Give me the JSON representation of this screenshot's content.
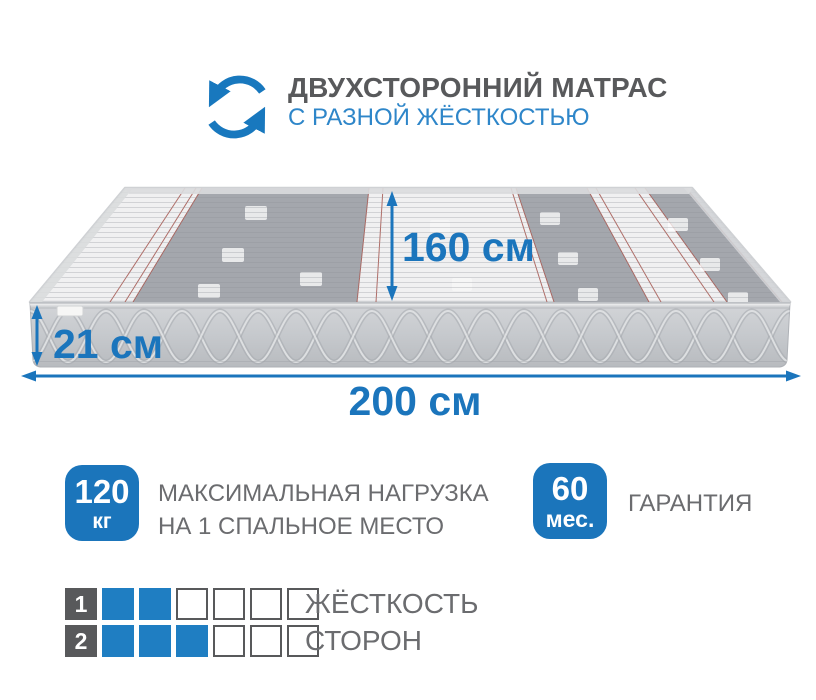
{
  "header": {
    "title": "ДВУХСТОРОННИЙ МАТРАС",
    "subtitle": "С РАЗНОЙ ЖЁСТКОСТЬЮ",
    "icon": "flip-rotate-arrows"
  },
  "mattress": {
    "width_label": "160 см",
    "height_label": "21 см",
    "length_label": "200 см"
  },
  "badges": [
    {
      "value": "120",
      "unit": "кг",
      "label_lines": [
        "МАКСИМАЛЬНАЯ НАГРУЗКА",
        "НА 1 СПАЛЬНОЕ МЕСТО"
      ]
    },
    {
      "value": "60",
      "unit": "мес.",
      "label_lines": [
        "ГАРАНТИЯ"
      ]
    }
  ],
  "firmness": {
    "label_lines": [
      "ЖЁСТКОСТЬ",
      "СТОРОН"
    ],
    "scale_max": 6,
    "rows": [
      {
        "side": "1",
        "level": 2
      },
      {
        "side": "2",
        "level": 3
      }
    ]
  },
  "colors": {
    "accent_blue": "#1b75bc",
    "subtitle_blue": "#2e86c9",
    "icon_blue": "#1878be",
    "square_blue": "#1f7ec2",
    "dark_gray": "#58595b",
    "label_gray": "#6b6c6f",
    "mattress_side_gray": "#c7cacd",
    "mattress_band_gray": "#a4a7ad",
    "pinstripe_red": "#a5564f"
  }
}
